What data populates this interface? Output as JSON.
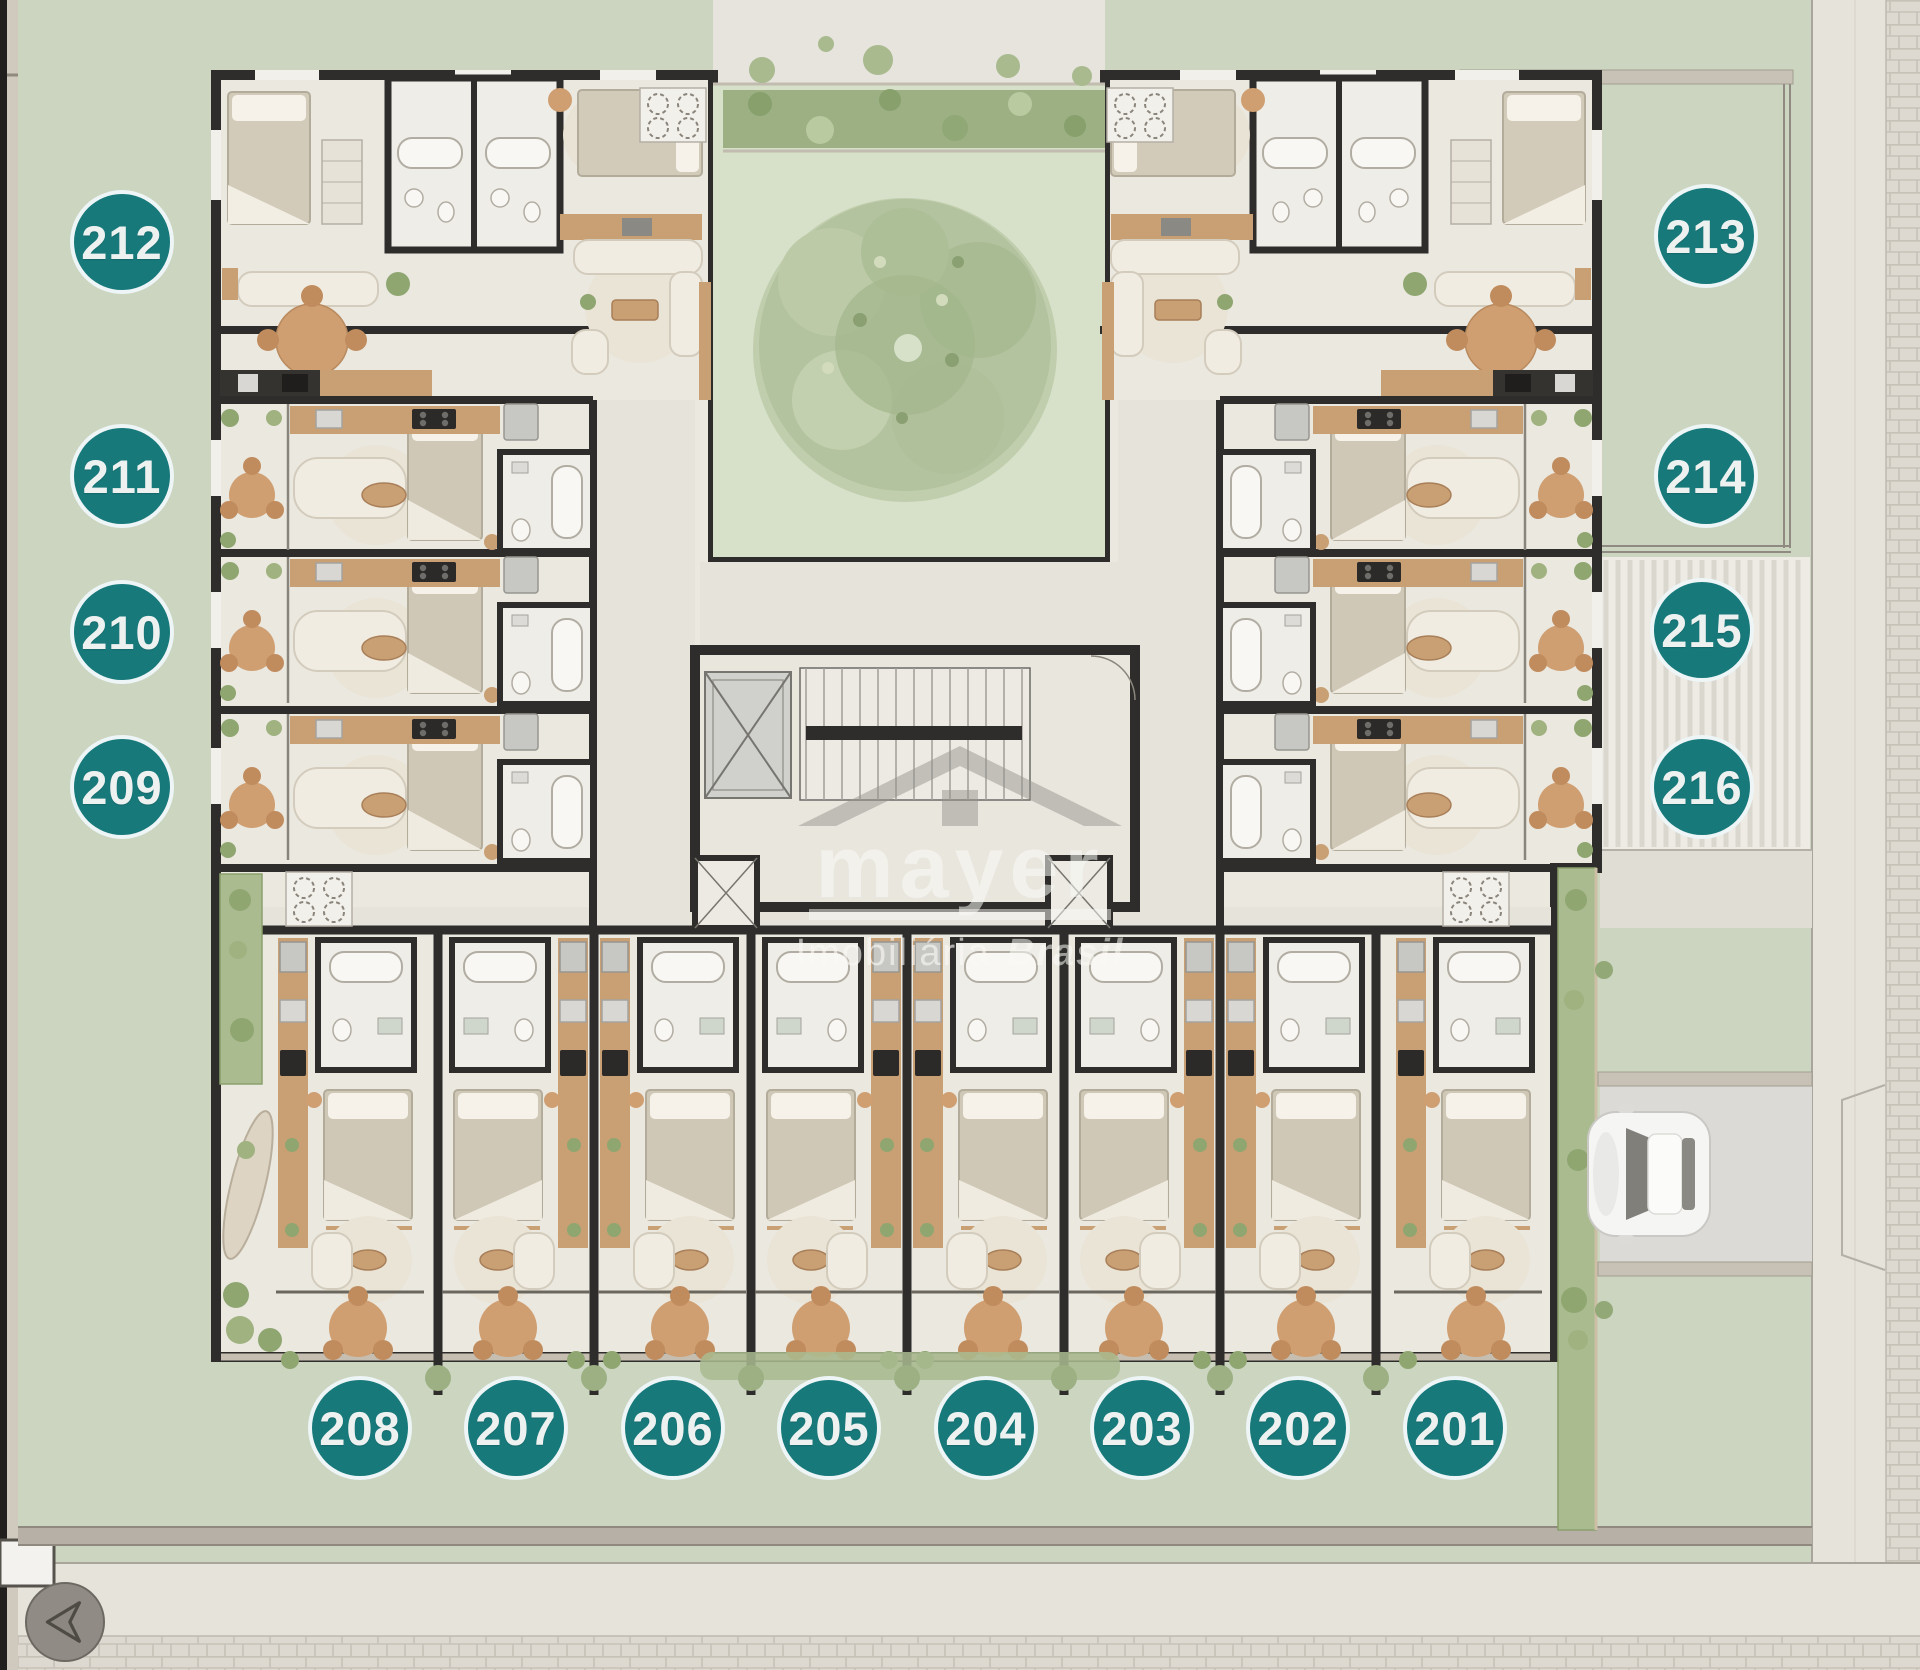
{
  "units": {
    "left": [
      "212",
      "211",
      "210",
      "209"
    ],
    "right_terrace": [
      "213",
      "214"
    ],
    "right_deck": [
      "215",
      "216"
    ],
    "bottom": [
      "208",
      "207",
      "206",
      "205",
      "204",
      "203",
      "202",
      "201"
    ]
  },
  "watermark": {
    "brand": "mayer",
    "subtitle_regular": "Imobiliária",
    "subtitle_italic": "Brasil"
  },
  "icons": {
    "back_button": "arrow-left-icon",
    "watermark_logo": "house-roof-icon"
  },
  "colors": {
    "background_green": "#cbd5c0",
    "courtyard_green": "#d7e1c9",
    "hedge_green": "#9cb083",
    "tree_green": "#b3c29f",
    "floor_cream": "#ebe8e0",
    "wall_dark": "#2e2d2b",
    "wood": "#c99f74",
    "pavement_grey": "#e6e3db",
    "fence_beige": "#b6b0a6",
    "driveway_grey": "#dbdad6",
    "badge_teal": "#18797b",
    "badge_text": "#edf2f1",
    "back_button_grey": "#908c85"
  }
}
